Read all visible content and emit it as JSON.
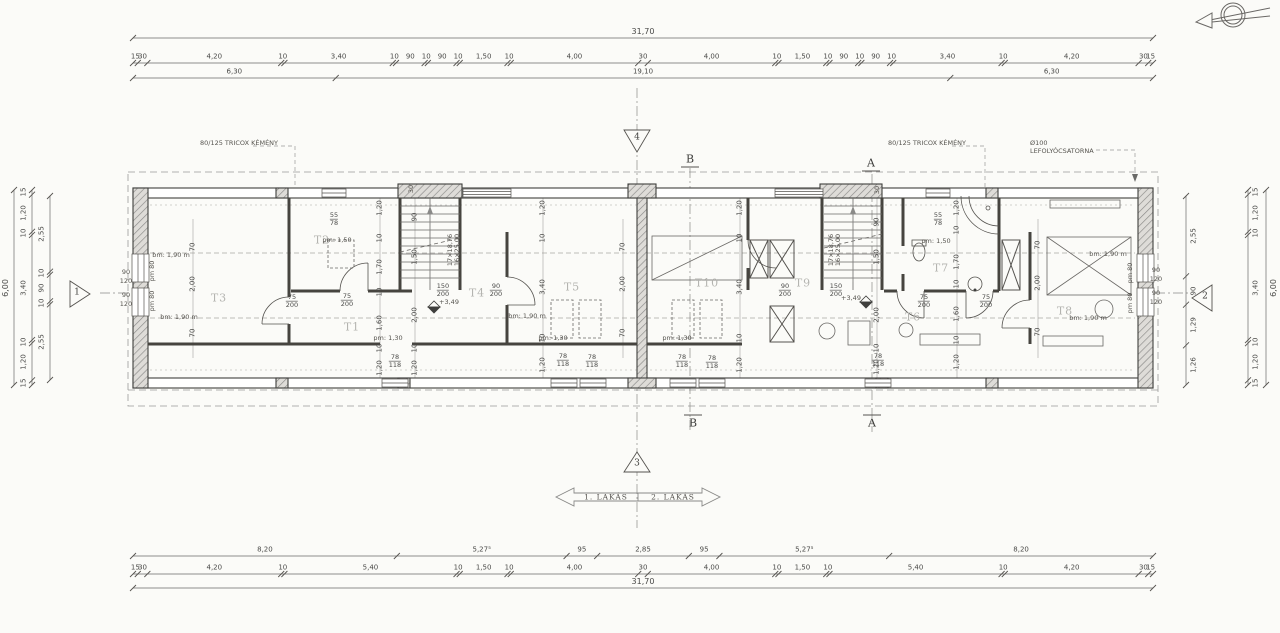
{
  "palette": {
    "ink": "#3f3f3d",
    "dim": "#4a4a48",
    "faint": "#9a9a98",
    "room_gray": "#b4b4b0",
    "wall_hatch": "#8a8a88"
  },
  "dim_chains": [
    {
      "n": "top-total",
      "o": "h",
      "x0": 133,
      "x1": 1153,
      "p": 38,
      "lo": -6,
      "big": 1,
      "segs": [
        "31,70"
      ]
    },
    {
      "n": "top-row1",
      "o": "h",
      "x0": 133,
      "x1": 1153,
      "p": 63,
      "lo": -6,
      "segs": [
        "15",
        "30",
        "4,20",
        "10",
        "3,40",
        "10",
        "90",
        "10",
        "90",
        "10",
        "1,50",
        "10",
        "4,00",
        "30",
        "4,00",
        "10",
        "1,50",
        "10",
        "90",
        "10",
        "90",
        "10",
        "3,40",
        "10",
        "4,20",
        "30",
        "15"
      ]
    },
    {
      "n": "top-row2",
      "o": "h",
      "x0": 133,
      "x1": 1153,
      "p": 78,
      "lo": -6,
      "segs": [
        "6,30",
        "19,10",
        "6,30"
      ]
    },
    {
      "n": "bottom-row1",
      "o": "h",
      "x0": 133,
      "x1": 1153,
      "p": 556,
      "lo": -6,
      "segs": [
        "8,20",
        "5,27⁵",
        "95",
        "2,85",
        "95",
        "5,27⁵",
        "8,20"
      ]
    },
    {
      "n": "bottom-row2",
      "o": "h",
      "x0": 133,
      "x1": 1153,
      "p": 574,
      "lo": -6,
      "segs": [
        "15",
        "30",
        "4,20",
        "10",
        "5,40",
        "10",
        "1,50",
        "10",
        "4,00",
        "30",
        "4,00",
        "10",
        "1,50",
        "10",
        "5,40",
        "10",
        "4,20",
        "30",
        "15"
      ]
    },
    {
      "n": "bottom-row3",
      "o": "h",
      "x0": 133,
      "x1": 1153,
      "p": 588,
      "lo": -6,
      "big": 1,
      "segs": [
        "31,70"
      ]
    },
    {
      "n": "left-total",
      "o": "v",
      "y0": 190,
      "y1": 385,
      "p": 14,
      "lo": -8,
      "big": 1,
      "segs": [
        "6,00"
      ]
    },
    {
      "n": "left-row1",
      "o": "v",
      "y0": 190,
      "y1": 385,
      "p": 32,
      "lo": -8,
      "segs": [
        "15",
        "1,20",
        "10",
        "3,40",
        "10",
        "1,20",
        "15"
      ]
    },
    {
      "n": "left-row2",
      "o": "v",
      "y0": 196,
      "y1": 380,
      "p": 50,
      "lo": -8,
      "segs": [
        "2,55",
        "10",
        "90",
        "10",
        "2,55"
      ]
    },
    {
      "n": "right-row1",
      "o": "v",
      "y0": 196,
      "y1": 385,
      "p": 1186,
      "lo": 8,
      "segs": [
        "2,55",
        "90",
        "1,29",
        "1,26"
      ]
    },
    {
      "n": "right-row2",
      "o": "v",
      "y0": 190,
      "y1": 385,
      "p": 1248,
      "lo": 8,
      "segs": [
        "15",
        "1,20",
        "10",
        "3,40",
        "10",
        "1,20",
        "15"
      ]
    },
    {
      "n": "right-total",
      "o": "v",
      "y0": 190,
      "y1": 385,
      "p": 1266,
      "lo": 8,
      "big": 1,
      "segs": [
        "6,00"
      ]
    }
  ],
  "interior_columns": [
    {
      "x": 193,
      "items": [
        [
          "70",
          247
        ],
        [
          "2,00",
          284
        ],
        [
          "70",
          333
        ]
      ]
    },
    {
      "x": 380,
      "items": [
        [
          "1,20",
          208
        ],
        [
          "10",
          238
        ],
        [
          "1,70",
          267
        ],
        [
          "10",
          292
        ],
        [
          "1,60",
          323
        ],
        [
          "10",
          348
        ],
        [
          "1,20",
          368
        ]
      ]
    },
    {
      "x": 415,
      "items": [
        [
          "90",
          217
        ],
        [
          "1,50",
          257
        ],
        [
          "2,00",
          315
        ],
        [
          "10",
          348
        ],
        [
          "1,20",
          368
        ]
      ]
    },
    {
      "x": 543,
      "items": [
        [
          "1,20",
          208
        ],
        [
          "10",
          238
        ],
        [
          "3,40",
          287
        ],
        [
          "10",
          338
        ],
        [
          "1,20",
          365
        ]
      ]
    },
    {
      "x": 623,
      "items": [
        [
          "70",
          247
        ],
        [
          "2,00",
          284
        ],
        [
          "70",
          333
        ]
      ]
    },
    {
      "x": 740,
      "items": [
        [
          "1,20",
          208
        ],
        [
          "10",
          238
        ],
        [
          "3,40",
          287
        ],
        [
          "10",
          338
        ],
        [
          "1,20",
          365
        ]
      ]
    },
    {
      "x": 877,
      "items": [
        [
          "90",
          222
        ],
        [
          "1,50",
          257
        ],
        [
          "2,00",
          315
        ],
        [
          "10",
          348
        ],
        [
          "1,20",
          367
        ]
      ]
    },
    {
      "x": 957,
      "items": [
        [
          "1,20",
          208
        ],
        [
          "10",
          230
        ],
        [
          "1,70",
          262
        ],
        [
          "10",
          284
        ],
        [
          "1,60",
          314
        ],
        [
          "10",
          340
        ],
        [
          "1,20",
          362
        ]
      ]
    },
    {
      "x": 1038,
      "items": [
        [
          "70",
          245
        ],
        [
          "2,00",
          283
        ],
        [
          "70",
          332
        ]
      ]
    }
  ],
  "rooms": [
    {
      "t": "T1",
      "x": 352,
      "y": 327
    },
    {
      "t": "T2",
      "x": 322,
      "y": 240
    },
    {
      "t": "T3",
      "x": 219,
      "y": 298
    },
    {
      "t": "T4",
      "x": 477,
      "y": 293
    },
    {
      "t": "T5",
      "x": 572,
      "y": 287
    },
    {
      "t": "T6",
      "x": 913,
      "y": 317
    },
    {
      "t": "T7",
      "x": 941,
      "y": 268
    },
    {
      "t": "T8",
      "x": 1065,
      "y": 311
    },
    {
      "t": "T9",
      "x": 803,
      "y": 283
    },
    {
      "t": "T10",
      "x": 707,
      "y": 283
    }
  ],
  "annotations": [
    {
      "t": "bm: 1,90 m",
      "x": 171,
      "y": 255
    },
    {
      "t": "bm: 1,90 m",
      "x": 179,
      "y": 317
    },
    {
      "t": "bm: 1,90 m",
      "x": 527,
      "y": 316
    },
    {
      "t": "bm: 1,90 m",
      "x": 1108,
      "y": 254
    },
    {
      "t": "bm: 1,90 m",
      "x": 1088,
      "y": 318
    },
    {
      "t": "pm: 1,50",
      "x": 337,
      "y": 240
    },
    {
      "t": "pm: 1,50",
      "x": 936,
      "y": 241
    },
    {
      "t": "pm: 1,30",
      "x": 388,
      "y": 338
    },
    {
      "t": "pm: 1,30",
      "x": 553,
      "y": 338
    },
    {
      "t": "pm: 1,30",
      "x": 677,
      "y": 338
    },
    {
      "t": "pm 80",
      "x": 152,
      "y": 271,
      "r": 1
    },
    {
      "t": "pm 80",
      "x": 152,
      "y": 301,
      "r": 1
    },
    {
      "t": "pm 80",
      "x": 1130,
      "y": 273,
      "r": 1
    },
    {
      "t": "pm 80",
      "x": 1130,
      "y": 303,
      "r": 1
    },
    {
      "t": "90",
      "x": 126,
      "y": 272
    },
    {
      "t": "120",
      "x": 126,
      "y": 281
    },
    {
      "t": "90",
      "x": 126,
      "y": 295
    },
    {
      "t": "120",
      "x": 126,
      "y": 304
    },
    {
      "t": "90",
      "x": 1156,
      "y": 270
    },
    {
      "t": "120",
      "x": 1156,
      "y": 279
    },
    {
      "t": "90",
      "x": 1156,
      "y": 293
    },
    {
      "t": "120",
      "x": 1156,
      "y": 302
    },
    {
      "t": "30",
      "x": 411,
      "y": 189,
      "r": 1
    },
    {
      "t": "30",
      "x": 877,
      "y": 190,
      "r": 1
    },
    {
      "t": "17×18,76",
      "x": 450,
      "y": 250,
      "r": 1
    },
    {
      "t": "16×25,00",
      "x": 457,
      "y": 250,
      "r": 1
    },
    {
      "t": "17×18,76",
      "x": 831,
      "y": 250,
      "r": 1
    },
    {
      "t": "16×25,00",
      "x": 838,
      "y": 250,
      "r": 1
    },
    {
      "t": "+3,49",
      "x": 449,
      "y": 302
    },
    {
      "t": "+3,49",
      "x": 851,
      "y": 298
    }
  ],
  "size_pairs": [
    {
      "a": "75",
      "b": "200",
      "x": 292,
      "y": 301
    },
    {
      "a": "75",
      "b": "200",
      "x": 347,
      "y": 300
    },
    {
      "a": "75",
      "b": "200",
      "x": 924,
      "y": 301
    },
    {
      "a": "75",
      "b": "200",
      "x": 986,
      "y": 301
    },
    {
      "a": "150",
      "b": "200",
      "x": 443,
      "y": 290
    },
    {
      "a": "150",
      "b": "200",
      "x": 836,
      "y": 290
    },
    {
      "a": "90",
      "b": "200",
      "x": 496,
      "y": 290
    },
    {
      "a": "90",
      "b": "200",
      "x": 785,
      "y": 290
    },
    {
      "a": "55",
      "b": "78",
      "x": 334,
      "y": 219
    },
    {
      "a": "55",
      "b": "78",
      "x": 938,
      "y": 219
    },
    {
      "a": "78",
      "b": "118",
      "x": 395,
      "y": 361
    },
    {
      "a": "78",
      "b": "118",
      "x": 563,
      "y": 360
    },
    {
      "a": "78",
      "b": "118",
      "x": 592,
      "y": 361
    },
    {
      "a": "78",
      "b": "118",
      "x": 682,
      "y": 361
    },
    {
      "a": "78",
      "b": "118",
      "x": 712,
      "y": 362
    },
    {
      "a": "78",
      "b": "118",
      "x": 878,
      "y": 360
    }
  ],
  "texts": {
    "chimney_left": "80/125 TRICOX KÉMÉNY",
    "chimney_right": "80/125 TRICOX KÉMÉNY",
    "gutter_line1": "Ø100",
    "gutter_line2": "LEFOLYÓCSATORNA",
    "lakas_left": "1. LAKÁS",
    "lakas_right": "2. LAKÁS",
    "section_a": "A",
    "section_b": "B",
    "marker_1": "1",
    "marker_2": "2",
    "marker_3": "3",
    "marker_4": "4"
  }
}
